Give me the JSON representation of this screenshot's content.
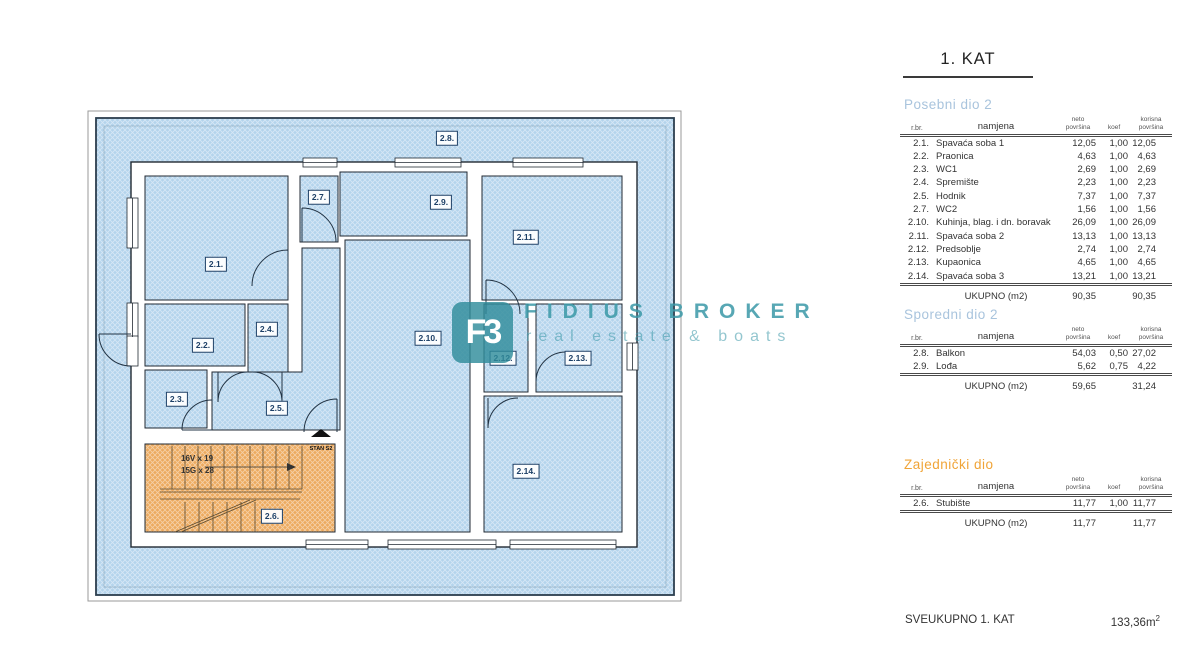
{
  "page": {
    "title": "1. KAT"
  },
  "watermark": {
    "logo_text": "F3",
    "name": "FIDIUS BROKER",
    "tagline": "real estate & boats"
  },
  "plan": {
    "rooms": [
      "2.1.",
      "2.2.",
      "2.3.",
      "2.4.",
      "2.5.",
      "2.6.",
      "2.7.",
      "2.8.",
      "2.9.",
      "2.10.",
      "2.11.",
      "2.12.",
      "2.13.",
      "2.14."
    ],
    "stairs": {
      "line1": "16V x 19",
      "line2": "15G x 28"
    },
    "unit_marker": "STAN S2"
  },
  "table_columns": [
    "r.br.",
    "namjena",
    "neto\npovršina",
    "koef",
    "korisna\npovršina"
  ],
  "tables": [
    {
      "heading": "Posebni dio 2",
      "heading_color": "#a9c4dd",
      "rows": [
        [
          "2.1.",
          "Spavaća soba 1",
          "12,05",
          "1,00",
          "12,05"
        ],
        [
          "2.2.",
          "Praonica",
          "4,63",
          "1,00",
          "4,63"
        ],
        [
          "2.3.",
          "WC1",
          "2,69",
          "1,00",
          "2,69"
        ],
        [
          "2.4.",
          "Spremište",
          "2,23",
          "1,00",
          "2,23"
        ],
        [
          "2.5.",
          "Hodnik",
          "7,37",
          "1,00",
          "7,37"
        ],
        [
          "2.7.",
          "WC2",
          "1,56",
          "1,00",
          "1,56"
        ],
        [
          "2.10.",
          "Kuhinja, blag. i dn. boravak",
          "26,09",
          "1,00",
          "26,09"
        ],
        [
          "2.11.",
          "Spavaća soba 2",
          "13,13",
          "1,00",
          "13,13"
        ],
        [
          "2.12.",
          "Predsoblje",
          "2,74",
          "1,00",
          "2,74"
        ],
        [
          "2.13.",
          "Kupaonica",
          "4,65",
          "1,00",
          "4,65"
        ],
        [
          "2.14.",
          "Spavaća soba 3",
          "13,21",
          "1,00",
          "13,21"
        ]
      ],
      "total": [
        "UKUPNO (m2)",
        "90,35",
        "",
        "90,35"
      ]
    },
    {
      "heading": "Sporedni dio 2",
      "heading_color": "#a9c4dd",
      "rows": [
        [
          "2.8.",
          "Balkon",
          "54,03",
          "0,50",
          "27,02"
        ],
        [
          "2.9.",
          "Lođa",
          "5,62",
          "0,75",
          "4,22"
        ]
      ],
      "total": [
        "UKUPNO (m2)",
        "59,65",
        "",
        "31,24"
      ]
    },
    {
      "heading": "Zajednički dio",
      "heading_color": "#f0a437",
      "rows": [
        [
          "2.6.",
          "Stubište",
          "11,77",
          "1,00",
          "11,77"
        ]
      ],
      "total": [
        "UKUPNO (m2)",
        "11,77",
        "",
        "11,77"
      ]
    }
  ],
  "grand_total": {
    "label": "SVEUKUPNO 1. KAT",
    "value": "133,36m",
    "sup": "2"
  },
  "colors": {
    "hatch_blue": "#b4d4ec",
    "hatch_orange": "#ecaa5f",
    "wall_outline": "#222a33",
    "room_label_blue": "#1c3f66",
    "heading_blue": "#a9c4dd",
    "heading_orange": "#f0a437",
    "watermark_teal": "#3a98a7",
    "text": "#333333"
  }
}
